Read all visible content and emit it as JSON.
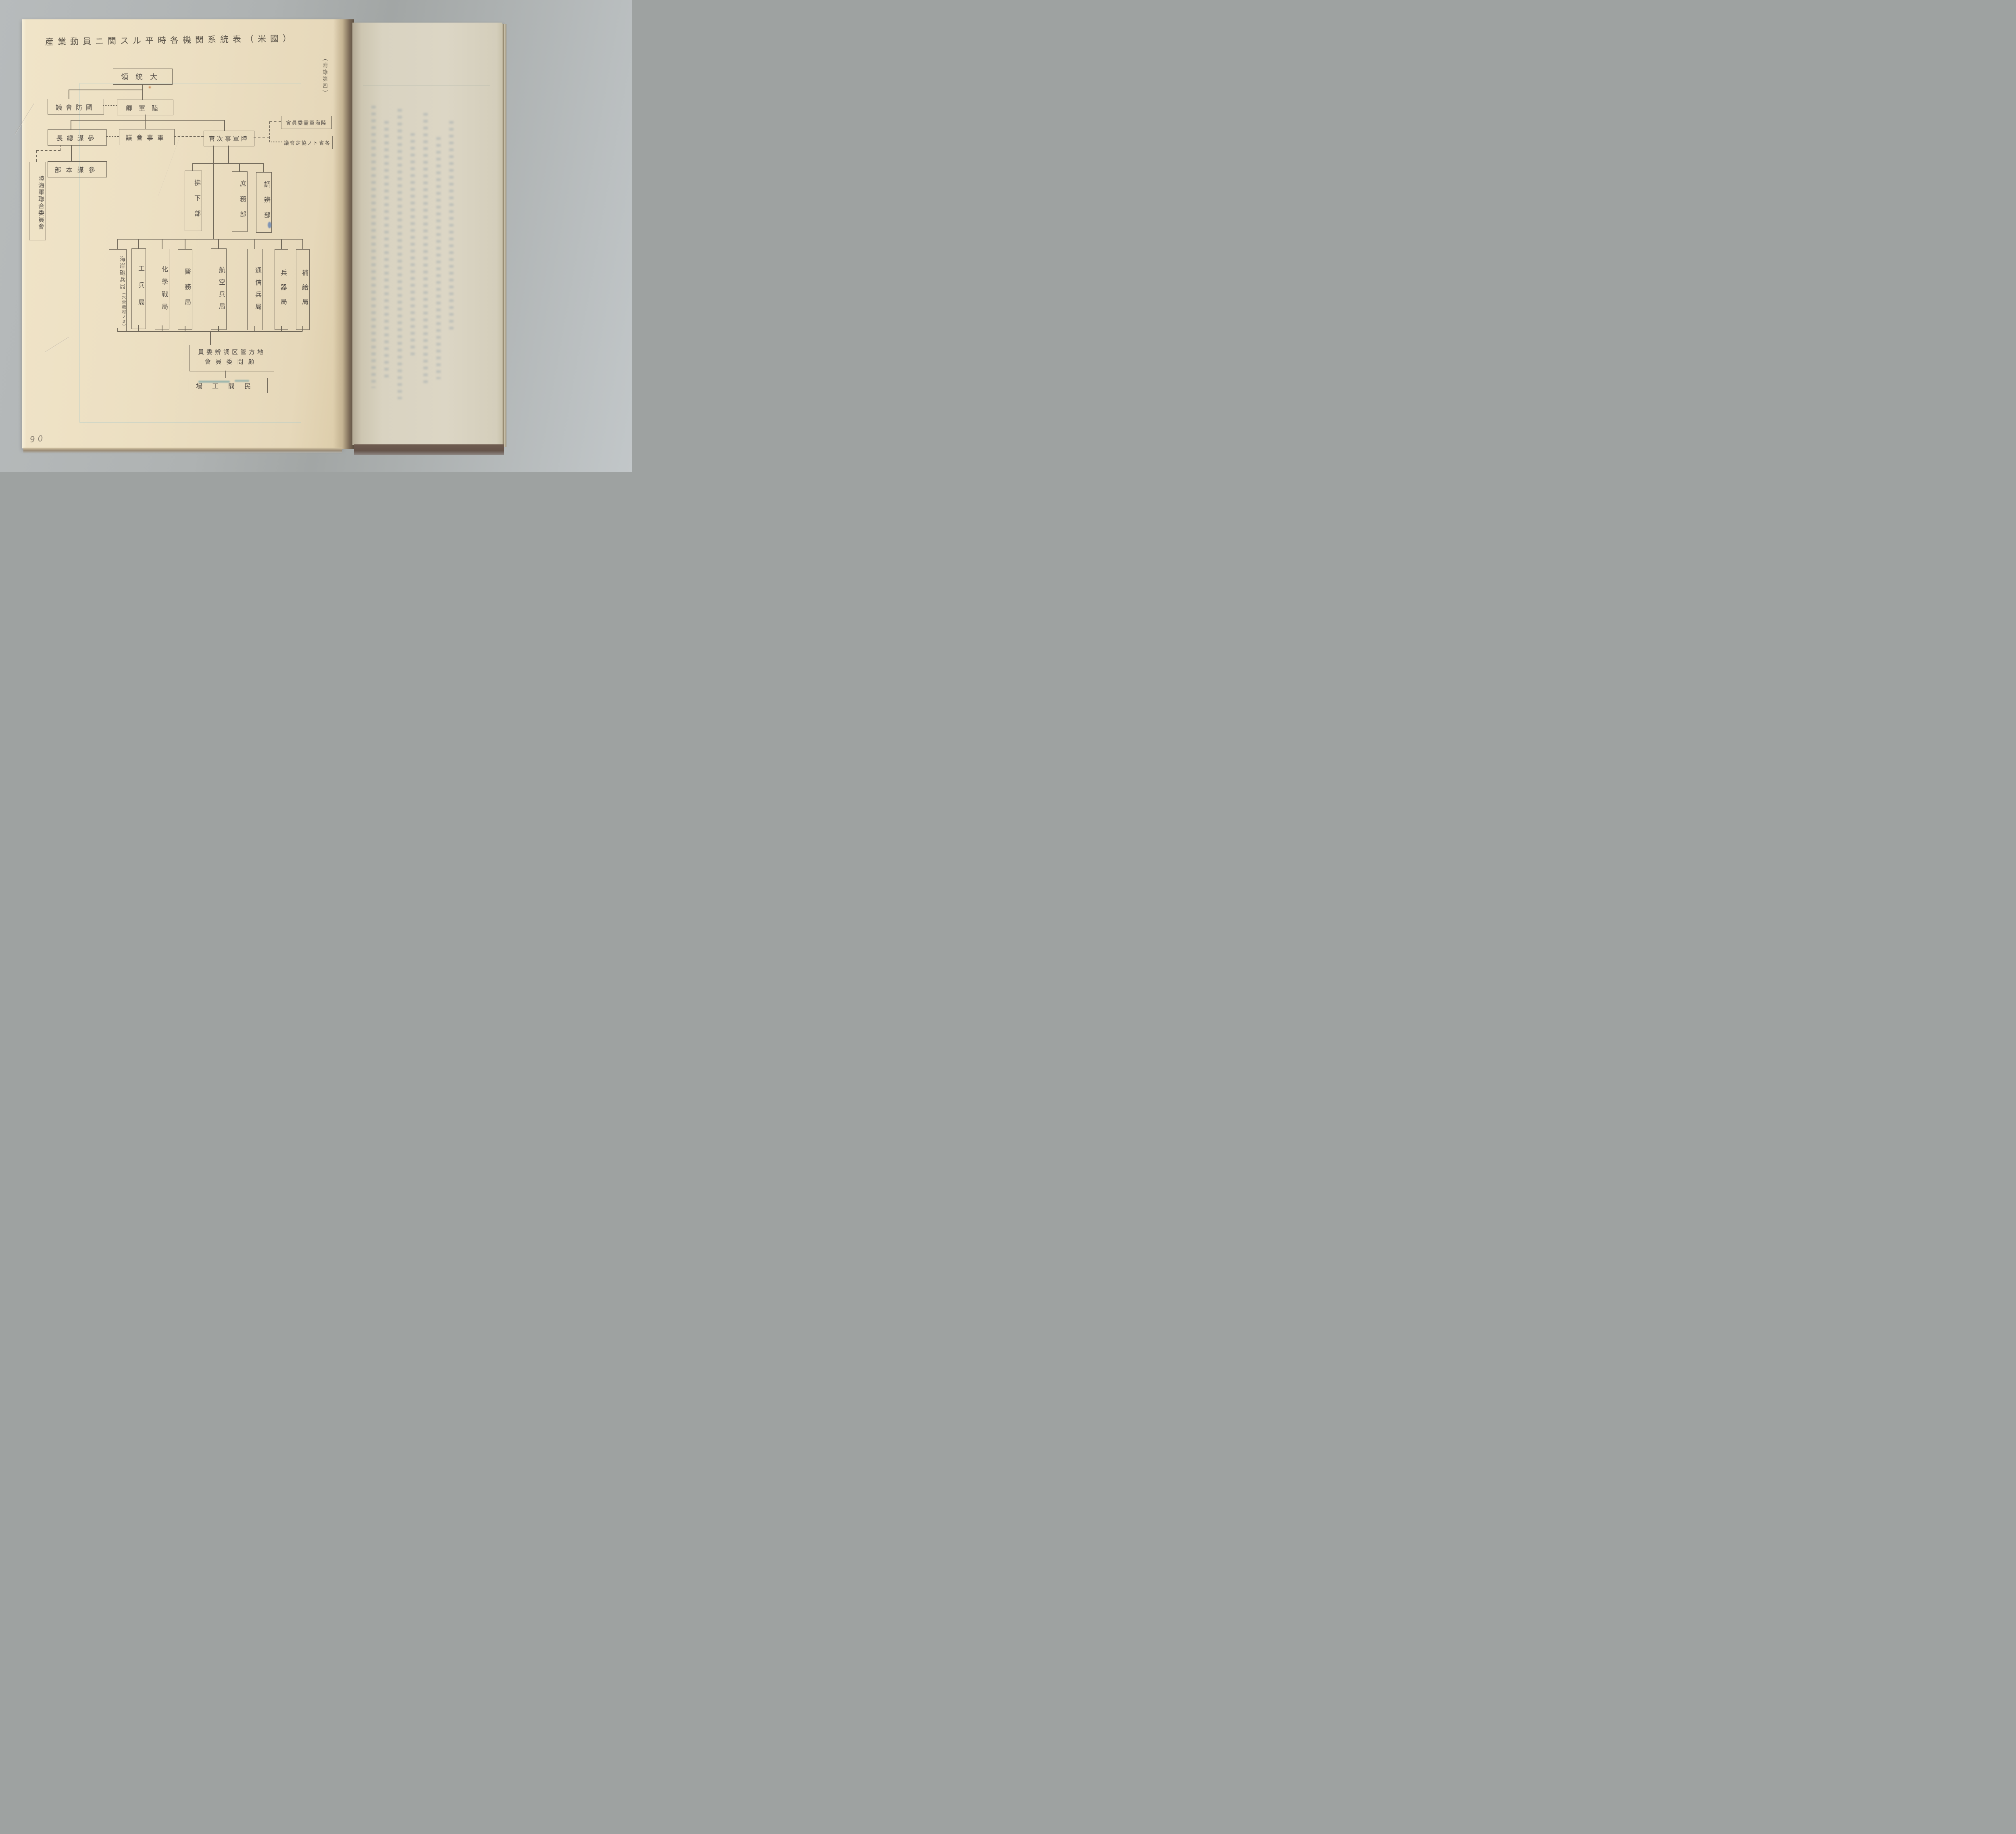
{
  "document": {
    "title": "産業動員ニ関スル平時各機関系統表（米國）",
    "margin_note": "（附錄第四）",
    "page_number": "90"
  },
  "chart": {
    "type": "org-chart",
    "reading_direction": "right-to-left, vertical box labels",
    "nodes": {
      "president": "大統領",
      "defense_council": "國防會議",
      "army_secretary": "陸軍卿",
      "chief_of_staff": "參謀總長",
      "military_council": "軍事會議",
      "army_vice_secretary": "陸軍事次官",
      "munitions_board": "陸海軍需委員會",
      "ministries_conference": "各省トノ協定會議",
      "general_staff_hq": "參謀本部",
      "joint_army_navy_board": "陸海軍聯合委員會",
      "sales_dept": "拂下部",
      "general_affairs_dept": "庶務部",
      "procurement_dept": "調辨部"
    },
    "bureaus": [
      {
        "label": "海岸砲兵局",
        "note": "（水雷機材ノミ）"
      },
      {
        "label": "工兵局"
      },
      {
        "label": "化學戰局"
      },
      {
        "label": "醫務局"
      },
      {
        "label": "航空兵局"
      },
      {
        "label": "通信兵局"
      },
      {
        "label": "兵器局"
      },
      {
        "label": "補給局"
      }
    ],
    "district_committee": {
      "line1": "地方管区調辨委員",
      "line2": "顧問委員會"
    },
    "civilian_factories": "民間工場"
  },
  "colors": {
    "background_grey": "#aeb2b2",
    "paper_left": "#ecdfc2",
    "paper_right": "#d9d3c1",
    "pencil_line": "#6f6759",
    "ink_text": "#56504a",
    "ink_blot_blue": "#6d88b5",
    "book_edge_brown": "#6f5c50"
  }
}
